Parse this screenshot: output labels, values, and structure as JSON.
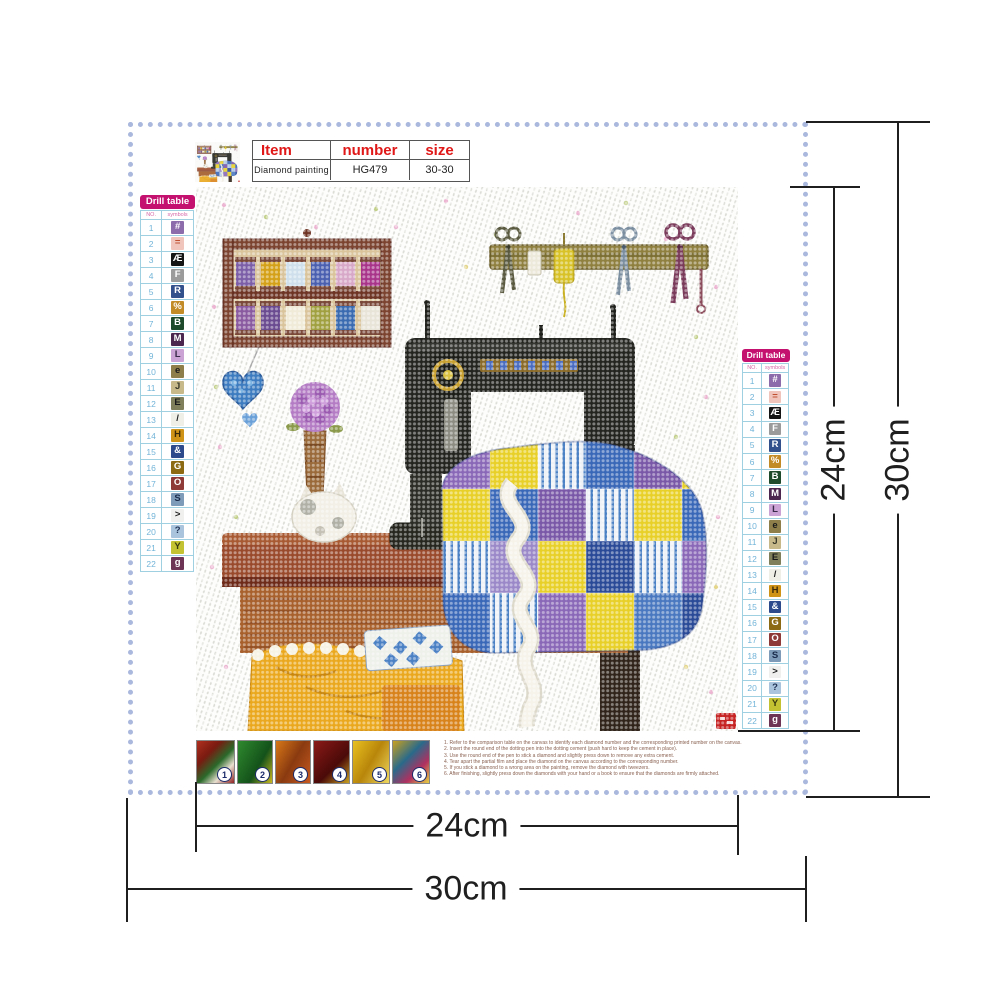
{
  "info_table": {
    "headers": [
      "Item",
      "number",
      "size"
    ],
    "row": [
      "Diamond painting",
      "HG479",
      "30-30"
    ]
  },
  "drill_table": {
    "title": "Drill table",
    "columns": [
      "NO.",
      "symbols"
    ],
    "rows": [
      {
        "no": "1",
        "symbol": "#",
        "bg": "#8d6cab",
        "fg": "#ffffff"
      },
      {
        "no": "2",
        "symbol": "=",
        "bg": "#f0c6bc",
        "fg": "#c05030"
      },
      {
        "no": "3",
        "symbol": "Æ",
        "bg": "#151515",
        "fg": "#ffffff"
      },
      {
        "no": "4",
        "symbol": "F",
        "bg": "#9b9b9b",
        "fg": "#ffffff"
      },
      {
        "no": "5",
        "symbol": "R",
        "bg": "#32508c",
        "fg": "#ffffff"
      },
      {
        "no": "6",
        "symbol": "%",
        "bg": "#c38b28",
        "fg": "#ffffff"
      },
      {
        "no": "7",
        "symbol": "B",
        "bg": "#1d4a2a",
        "fg": "#ffffff"
      },
      {
        "no": "8",
        "symbol": "M",
        "bg": "#4b2750",
        "fg": "#ffffff"
      },
      {
        "no": "9",
        "symbol": "L",
        "bg": "#cba3d4",
        "fg": "#3a2a4a"
      },
      {
        "no": "10",
        "symbol": "e",
        "bg": "#8e7f4a",
        "fg": "#1a1a1a"
      },
      {
        "no": "11",
        "symbol": "J",
        "bg": "#c7b98a",
        "fg": "#3a3a2a"
      },
      {
        "no": "12",
        "symbol": "E",
        "bg": "#7f7f5c",
        "fg": "#1a1a1a"
      },
      {
        "no": "13",
        "symbol": "/",
        "bg": "#efefe8",
        "fg": "#222222"
      },
      {
        "no": "14",
        "symbol": "H",
        "bg": "#cf9318",
        "fg": "#3a2a0a"
      },
      {
        "no": "15",
        "symbol": "&",
        "bg": "#2c4a8c",
        "fg": "#ffffff"
      },
      {
        "no": "16",
        "symbol": "G",
        "bg": "#8c6a14",
        "fg": "#ffffff"
      },
      {
        "no": "17",
        "symbol": "O",
        "bg": "#8e3a38",
        "fg": "#ffffff"
      },
      {
        "no": "18",
        "symbol": "S",
        "bg": "#7e9cba",
        "fg": "#1a2a4a"
      },
      {
        "no": "19",
        "symbol": ">",
        "bg": "#f0f0ee",
        "fg": "#222222"
      },
      {
        "no": "20",
        "symbol": "?",
        "bg": "#a9c4dc",
        "fg": "#223355"
      },
      {
        "no": "21",
        "symbol": "Y",
        "bg": "#c2c232",
        "fg": "#3a3a10"
      },
      {
        "no": "22",
        "symbol": "g",
        "bg": "#6d3456",
        "fg": "#ffffff"
      }
    ]
  },
  "dimensions": {
    "canvas_width": "24cm",
    "canvas_height": "24cm",
    "total_width": "30cm",
    "total_height": "30cm"
  },
  "steps": [
    "1",
    "2",
    "3",
    "4",
    "5",
    "6"
  ],
  "instructions": [
    "1. Refer to the comparison table on the canvas to identify each diamond number and the corresponding printed number on the canvas.",
    "2. Insert the round end of the dotting pen into the dotting cement (push hard to keep the cement in place).",
    "3. Use the round end of the pen to stick a diamond and slightly press down to remove any extra cement.",
    "4. Tear apart the partial film and place the diamond on the canvas according to the corresponding number.",
    "5. If you stick a diamond to a wrong area on the painting, remove the diamond with tweezers.",
    "6. After finishing, slightly press down the diamonds with your hand or a book to ensure that the diamonds are firmly attached."
  ],
  "colors": {
    "accent_red": "#e01818",
    "drill_header_bg": "#c4116f",
    "drill_header_text": "#ffffff",
    "border_blue": "#aab8de",
    "dimension_color": "#1f1f1f"
  }
}
